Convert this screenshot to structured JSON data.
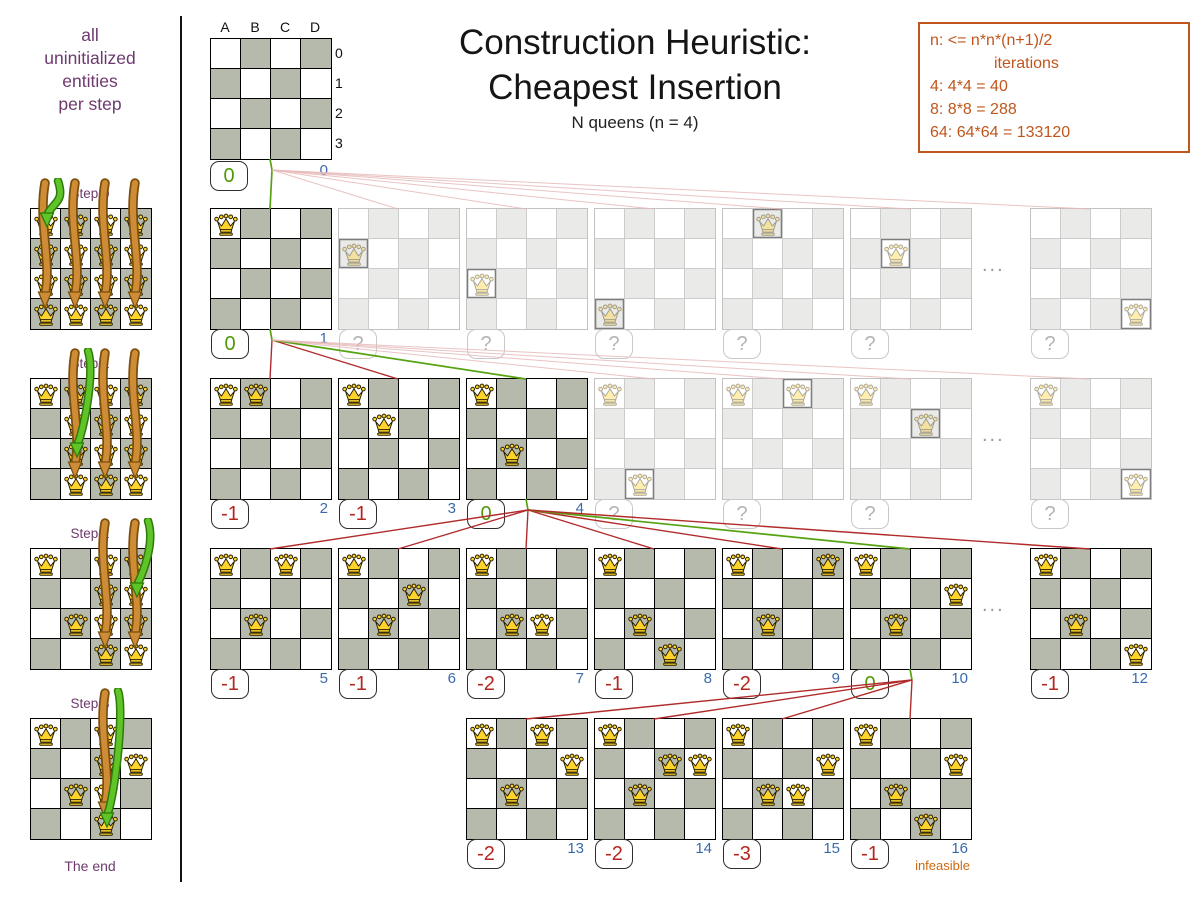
{
  "sidebar": {
    "intro_lines": [
      "all",
      "uninitialized",
      "entities",
      "per step"
    ],
    "steps": [
      {
        "label": "Step 0",
        "fixed": [],
        "candidate_cols": [
          0,
          1,
          2,
          3
        ],
        "green_target": [
          0,
          0
        ]
      },
      {
        "label": "Step 1",
        "fixed": [
          [
            0,
            0
          ]
        ],
        "candidate_cols": [
          1,
          2,
          3
        ],
        "green_target": [
          1,
          2
        ]
      },
      {
        "label": "Step 2",
        "fixed": [
          [
            0,
            0
          ],
          [
            1,
            2
          ]
        ],
        "candidate_cols": [
          2,
          3
        ],
        "green_target": [
          3,
          1
        ]
      },
      {
        "label": "Step 3",
        "fixed": [
          [
            0,
            0
          ],
          [
            1,
            2
          ],
          [
            3,
            1
          ]
        ],
        "candidate_cols": [
          2
        ],
        "green_target": [
          2,
          3
        ]
      }
    ],
    "end_label": "The end"
  },
  "header": {
    "title_line1": "Construction Heuristic:",
    "title_line2": "Cheapest Insertion",
    "subtitle": "N queens (n = 4)"
  },
  "info_box": {
    "line1": "n: <= n*n*(n+1)/2",
    "line2": "iterations",
    "line3": "4: 4*4 = 40",
    "line4": "8: 8*8 = 288",
    "line5": "64: 64*64 = 133120"
  },
  "board_labels": {
    "cols": [
      "A",
      "B",
      "C",
      "D"
    ],
    "rows": [
      "0",
      "1",
      "2",
      "3"
    ]
  },
  "tree": {
    "ellipsis_label": "...",
    "root": {
      "queens": [],
      "score": "0",
      "iter": "0",
      "type": "selected"
    },
    "rows": [
      {
        "ellipsis": true,
        "boards": [
          {
            "slot": 0,
            "queens": [
              [
                0,
                0
              ]
            ],
            "score": "0",
            "iter": "1",
            "type": "selected"
          },
          {
            "slot": 1,
            "queens": [
              [
                0,
                1
              ]
            ],
            "score": "?",
            "iter": "",
            "type": "faded"
          },
          {
            "slot": 2,
            "queens": [
              [
                0,
                2
              ]
            ],
            "score": "?",
            "iter": "",
            "type": "faded"
          },
          {
            "slot": 3,
            "queens": [
              [
                0,
                3
              ]
            ],
            "score": "?",
            "iter": "",
            "type": "faded"
          },
          {
            "slot": 4,
            "queens": [
              [
                1,
                0
              ]
            ],
            "score": "?",
            "iter": "",
            "type": "faded"
          },
          {
            "slot": 5,
            "queens": [
              [
                1,
                1
              ]
            ],
            "score": "?",
            "iter": "",
            "type": "faded"
          },
          {
            "slot": 6,
            "queens": [
              [
                3,
                3
              ]
            ],
            "score": "?",
            "iter": "",
            "type": "faded"
          }
        ]
      },
      {
        "ellipsis": true,
        "boards": [
          {
            "slot": 0,
            "queens": [
              [
                0,
                0
              ],
              [
                1,
                0
              ]
            ],
            "score": "-1",
            "iter": "2",
            "type": "explored"
          },
          {
            "slot": 1,
            "queens": [
              [
                0,
                0
              ],
              [
                1,
                1
              ]
            ],
            "score": "-1",
            "iter": "3",
            "type": "explored"
          },
          {
            "slot": 2,
            "queens": [
              [
                0,
                0
              ],
              [
                1,
                2
              ]
            ],
            "score": "0",
            "iter": "4",
            "type": "selected"
          },
          {
            "slot": 3,
            "queens": [
              [
                0,
                0
              ],
              [
                1,
                3
              ]
            ],
            "score": "?",
            "iter": "",
            "type": "faded"
          },
          {
            "slot": 4,
            "queens": [
              [
                0,
                0
              ],
              [
                2,
                0
              ]
            ],
            "score": "?",
            "iter": "",
            "type": "faded"
          },
          {
            "slot": 5,
            "queens": [
              [
                0,
                0
              ],
              [
                2,
                1
              ]
            ],
            "score": "?",
            "iter": "",
            "type": "faded"
          },
          {
            "slot": 6,
            "queens": [
              [
                0,
                0
              ],
              [
                3,
                3
              ]
            ],
            "score": "?",
            "iter": "",
            "type": "faded"
          }
        ]
      },
      {
        "ellipsis": true,
        "boards": [
          {
            "slot": 0,
            "queens": [
              [
                0,
                0
              ],
              [
                1,
                2
              ],
              [
                2,
                0
              ]
            ],
            "score": "-1",
            "iter": "5",
            "type": "explored"
          },
          {
            "slot": 1,
            "queens": [
              [
                0,
                0
              ],
              [
                1,
                2
              ],
              [
                2,
                1
              ]
            ],
            "score": "-1",
            "iter": "6",
            "type": "explored"
          },
          {
            "slot": 2,
            "queens": [
              [
                0,
                0
              ],
              [
                1,
                2
              ],
              [
                2,
                2
              ]
            ],
            "score": "-2",
            "iter": "7",
            "type": "explored"
          },
          {
            "slot": 3,
            "queens": [
              [
                0,
                0
              ],
              [
                1,
                2
              ],
              [
                2,
                3
              ]
            ],
            "score": "-1",
            "iter": "8",
            "type": "explored"
          },
          {
            "slot": 4,
            "queens": [
              [
                0,
                0
              ],
              [
                1,
                2
              ],
              [
                3,
                0
              ]
            ],
            "score": "-2",
            "iter": "9",
            "type": "explored"
          },
          {
            "slot": 5,
            "queens": [
              [
                0,
                0
              ],
              [
                1,
                2
              ],
              [
                3,
                1
              ]
            ],
            "score": "0",
            "iter": "10",
            "type": "selected"
          },
          {
            "slot": 6,
            "queens": [
              [
                0,
                0
              ],
              [
                1,
                2
              ],
              [
                3,
                3
              ]
            ],
            "score": "-1",
            "iter": "12",
            "type": "explored"
          }
        ]
      },
      {
        "ellipsis": false,
        "boards": [
          {
            "slot": 2,
            "queens": [
              [
                0,
                0
              ],
              [
                1,
                2
              ],
              [
                3,
                1
              ],
              [
                2,
                0
              ]
            ],
            "score": "-2",
            "iter": "13",
            "type": "explored"
          },
          {
            "slot": 3,
            "queens": [
              [
                0,
                0
              ],
              [
                1,
                2
              ],
              [
                3,
                1
              ],
              [
                2,
                1
              ]
            ],
            "score": "-2",
            "iter": "14",
            "type": "explored"
          },
          {
            "slot": 4,
            "queens": [
              [
                0,
                0
              ],
              [
                1,
                2
              ],
              [
                3,
                1
              ],
              [
                2,
                2
              ]
            ],
            "score": "-3",
            "iter": "15",
            "type": "explored"
          },
          {
            "slot": 5,
            "queens": [
              [
                0,
                0
              ],
              [
                1,
                2
              ],
              [
                3,
                1
              ],
              [
                2,
                3
              ]
            ],
            "score": "-1",
            "iter": "16",
            "type": "explored",
            "note": "infeasible"
          }
        ]
      }
    ]
  },
  "palette": {
    "purple": "#6e3a6e",
    "orange": "#c0561c",
    "red_score": "#b3281e",
    "green_score": "#4e9a06",
    "blue_iter": "#3a6aad",
    "line_red": "#b22b2b",
    "line_green": "#56a312",
    "line_faded": "#e6b8b8",
    "arrow_orange": "#cd8c35",
    "arrow_orange_dark": "#7c4f0c",
    "arrow_green": "#5ec427",
    "arrow_green_dark": "#2f7a0a",
    "board_dark_square": "#b6baac",
    "queen_gold": "#ffd42a"
  }
}
